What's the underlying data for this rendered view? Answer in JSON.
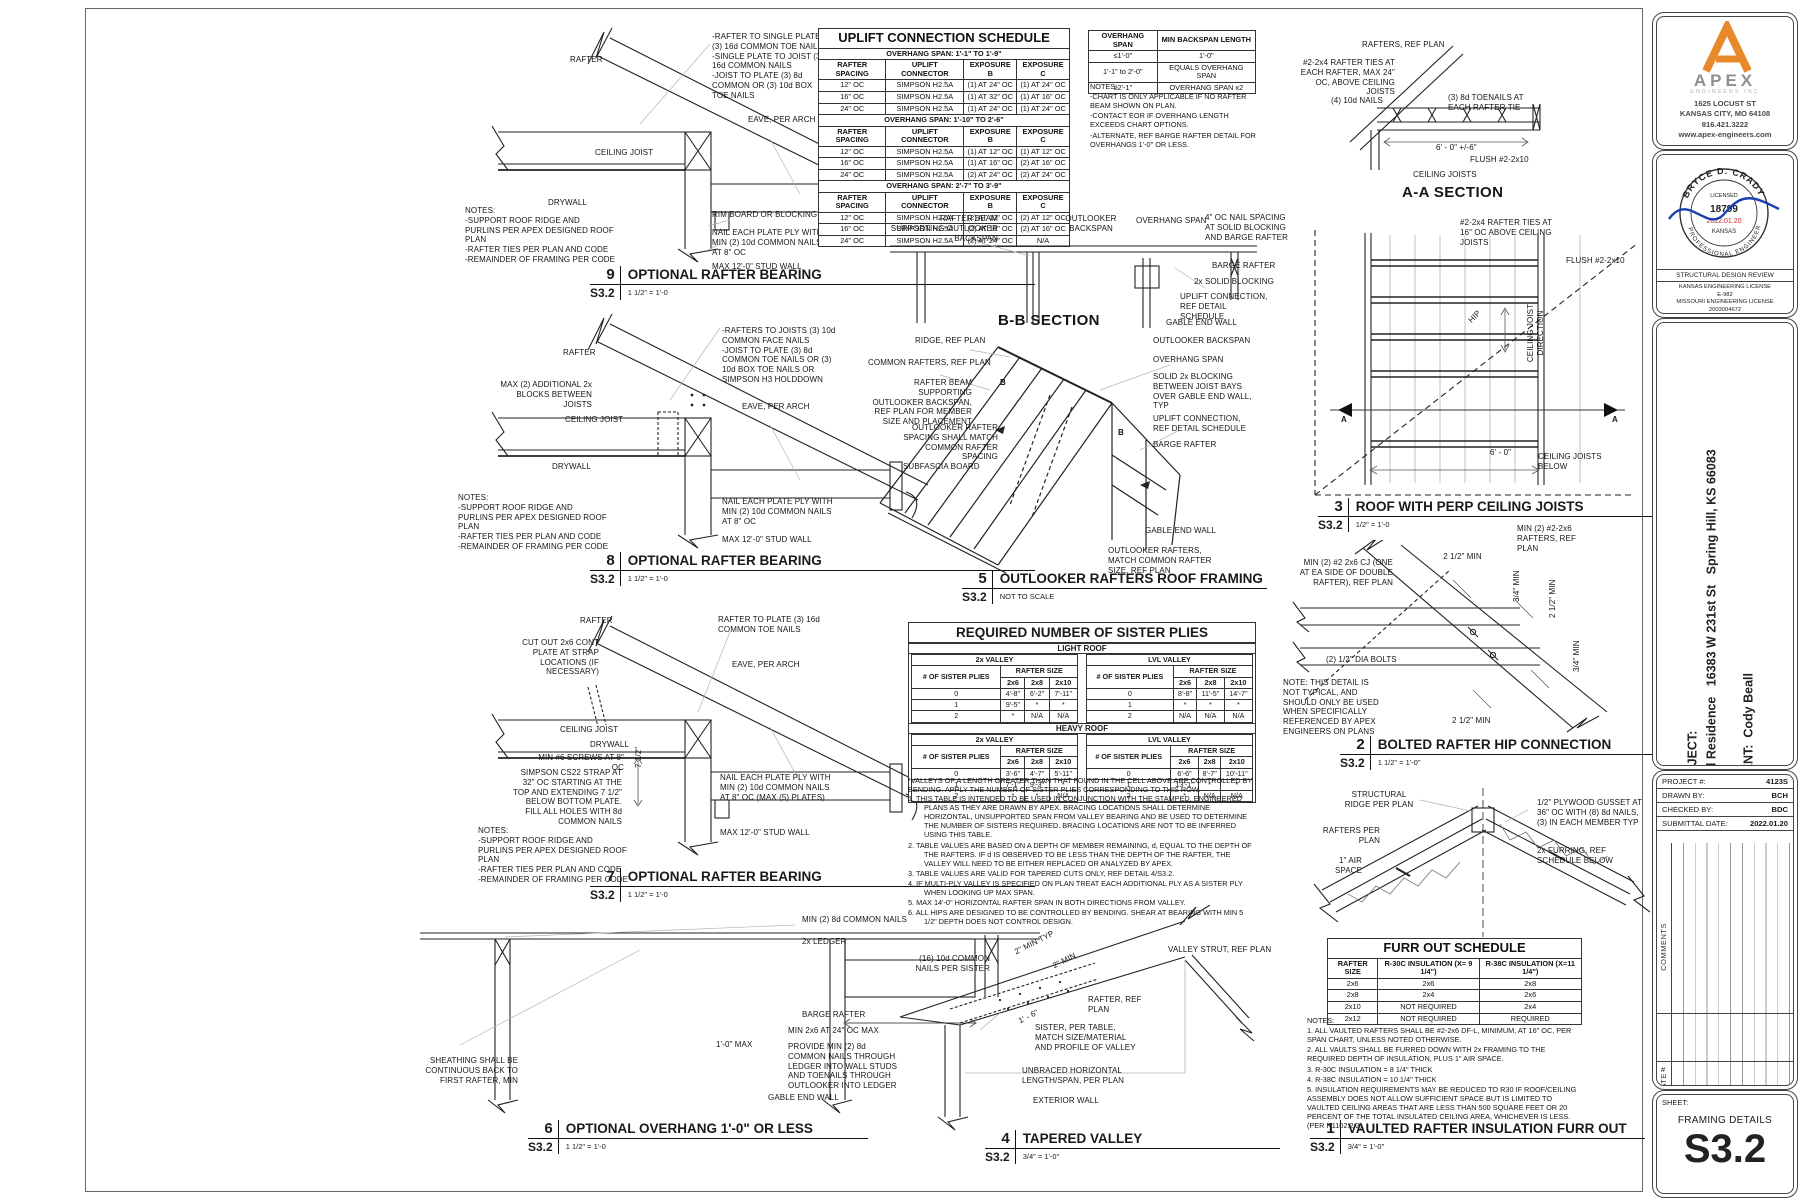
{
  "sheet": {
    "label": "SHEET:",
    "title": "FRAMING DETAILS",
    "number": "S3.2"
  },
  "firm": {
    "name": "APEX",
    "tag": "ENGINEERS INC",
    "address1": "1625 LOCUST ST",
    "address2": "KANSAS CITY, MO 64108",
    "phone": "816.421.3222",
    "web": "www.apex-engineers.com",
    "accent": "#E8892B"
  },
  "stamp": {
    "name": "BRYCE D. CRADY",
    "licensed": "LICENSED",
    "number": "18799",
    "date": "2022.01.20",
    "state": "KANSAS",
    "profession": "PROFESSIONAL ENGINEER",
    "review": "STRUCTURAL DESIGN REVIEW",
    "license1": "KANSAS ENGINEERING LICENSE",
    "license1b": "E-982",
    "license2": "MISSOURI ENGINEERING LICENSE",
    "license2b": "2003004672"
  },
  "project": {
    "label": "PROJECT:",
    "name": "Beall Residence",
    "addr1": "16383 W 231st St",
    "addr2": "Spring Hill, KS 66083",
    "client_label": "CLIENT:",
    "client": "Cody Beall"
  },
  "titleblock": {
    "project_no_label": "PROJECT #:",
    "project_no": "4123S",
    "drawn_label": "DRAWN BY:",
    "drawn": "BCH",
    "checked_label": "CHECKED BY:",
    "checked": "BDC",
    "submittal_label": "SUBMITTAL DATE:",
    "submittal": "2022.01.20",
    "comments": "COMMENTS",
    "date": "DATE",
    "num": "#"
  },
  "uplift": {
    "title": "UPLIFT CONNECTION SCHEDULE",
    "col_headers": [
      "RAFTER SPACING",
      "UPLIFT CONNECTOR",
      "EXPOSURE B",
      "EXPOSURE C"
    ],
    "sections": [
      {
        "span": "OVERHANG SPAN: 1'-1\" TO 1'-9\"",
        "rows": [
          [
            "12\" OC",
            "SIMPSON H2.5A",
            "(1) AT 24\" OC",
            "(1) AT 24\" OC"
          ],
          [
            "16\" OC",
            "SIMPSON H2.5A",
            "(1) AT 32\" OC",
            "(1) AT 16\" OC"
          ],
          [
            "24\" OC",
            "SIMPSON H2.5A",
            "(1) AT 24\" OC",
            "(1) AT 24\" OC"
          ]
        ]
      },
      {
        "span": "OVERHANG SPAN: 1'-10\" TO 2'-6\"",
        "rows": [
          [
            "12\" OC",
            "SIMPSON H2.5A",
            "(1) AT 12\" OC",
            "(1) AT 12\" OC"
          ],
          [
            "16\" OC",
            "SIMPSON H2.5A",
            "(1) AT 16\" OC",
            "(2) AT 16\" OC"
          ],
          [
            "24\" OC",
            "SIMPSON H2.5A",
            "(2) AT 24\" OC",
            "(2) AT 24\" OC"
          ]
        ]
      },
      {
        "span": "OVERHANG SPAN: 2'-7\" TO 3'-9\"",
        "rows": [
          [
            "12\" OC",
            "SIMPSON H2.5A",
            "(2) AT 12\" OC",
            "(2) AT 12\" OC"
          ],
          [
            "16\" OC",
            "SIMPSON H2.5A",
            "(2) AT 16\" OC",
            "(2) AT 16\" OC"
          ],
          [
            "24\" OC",
            "SIMPSON H2.5A",
            "(2) AT 24\" OC",
            "N/A"
          ]
        ]
      }
    ]
  },
  "backspan": {
    "headers": [
      "OVERHANG SPAN",
      "MIN BACKSPAN LENGTH"
    ],
    "rows": [
      [
        "≤1'-0\"",
        "1'-0\""
      ],
      [
        "1'-1\" to 2'-0\"",
        "EQUALS OVERHANG SPAN"
      ],
      [
        "≥2'-1\"",
        "OVERHANG SPAN x2"
      ]
    ],
    "notes": [
      "NOTES:",
      "-CHART IS ONLY APPLICABLE IF NO RAFTER BEAM SHOWN ON PLAN.",
      "-CONTACT EOR IF OVERHANG LENGTH EXCEEDS CHART OPTIONS.",
      "-ALTERNATE, REF BARGE RAFTER DETAIL FOR OVERHANGS 1'-0\" OR LESS."
    ]
  },
  "sister": {
    "title": "REQUIRED NUMBER OF SISTER PLIES",
    "light_label": "LIGHT ROOF",
    "heavy_label": "HEAVY ROOF",
    "plies_header": "# OF SISTER PLIES",
    "size_header": "RAFTER SIZE",
    "sizes": [
      "2x6",
      "2x8",
      "2x10"
    ],
    "light_2x": {
      "label": "2x VALLEY",
      "rows": [
        [
          "0",
          "4'-8\"",
          "6'-2\"",
          "7'-11\""
        ],
        [
          "1",
          "9'-5\"",
          "*",
          "*"
        ],
        [
          "2",
          "*",
          "N/A",
          "N/A"
        ]
      ]
    },
    "light_lvl": {
      "label": "LVL VALLEY",
      "rows": [
        [
          "0",
          "8'-8\"",
          "11'-5\"",
          "14'-7\""
        ],
        [
          "1",
          "*",
          "*",
          "*"
        ],
        [
          "2",
          "N/A",
          "N/A",
          "N/A"
        ]
      ]
    },
    "heavy_2x": {
      "label": "2x VALLEY",
      "rows": [
        [
          "0",
          "3'-6\"",
          "4'-7\"",
          "5'-11\""
        ],
        [
          "1",
          "7'-1\"",
          "9'-3\"",
          "*"
        ],
        [
          "2",
          "*",
          "*",
          "N/A"
        ]
      ]
    },
    "heavy_lvl": {
      "label": "LVL VALLEY",
      "rows": [
        [
          "0",
          "6'-6\"",
          "8'-7\"",
          "10'-11\""
        ],
        [
          "1",
          "13'-1\"",
          "*",
          "*"
        ],
        [
          "2",
          "*",
          "N/A",
          "N/A"
        ]
      ]
    },
    "footnote": "*VALLEYS OF A LENGTH GREATER THAN THAT FOUND IN THE CELL ABOVE ARE CONTROLLED BY BENDING. APPLY THE NUMBER OF SISTER PLIES CORRESPONDING TO THIS ROW.",
    "notes": [
      "1.  THIS TABLE IS INTENDED TO BE USED IN CONJUNCTION WITH THE STAMPED, ENGINEERED PLANS AS THEY ARE DRAWN BY APEX.  BRACING LOCATIONS SHALL DETERMINE HORIZONTAL, UNSUPPORTED SPAN FROM VALLEY BEARING AND BE USED TO DETERMINE THE NUMBER OF SISTERS REQUIRED.  BRACING LOCATIONS ARE NOT TO BE INFERRED USING THIS TABLE.",
      "2.  TABLE VALUES ARE BASED ON A DEPTH OF MEMBER REMAINING, d, EQUAL TO THE DEPTH OF THE RAFTERS. IF d IS OBSERVED TO BE LESS THAN THE DEPTH OF THE RAFTER, THE VALLEY WILL NEED TO BE EITHER REPLACED OR ANALYZED BY APEX.",
      "3.  TABLE VALUES ARE VALID FOR TAPERED CUTS ONLY, REF DETAIL 4/S3.2.",
      "4.  IF MULTI-PLY VALLEY IS SPECIFIED ON PLAN TREAT EACH ADDITIONAL PLY AS A SISTER PLY WHEN LOOKING UP MAX SPAN.",
      "5.  MAX 14'-0\" HORIZONTAL RAFTER SPAN IN BOTH DIRECTIONS FROM VALLEY.",
      "6.  ALL HIPS ARE DESIGNED TO BE CONTROLLED BY BENDING.  SHEAR AT BEARING WITH MIN 5 1/2\" DEPTH DOES NOT CONTROL DESIGN."
    ]
  },
  "furr": {
    "title": "FURR OUT SCHEDULE",
    "headers": [
      "RAFTER SIZE",
      "R-30C INSULATION (X= 9 1/4\")",
      "R-38C INSULATION (X=11 1/4\")"
    ],
    "rows": [
      [
        "2x6",
        "2x6",
        "2x8"
      ],
      [
        "2x8",
        "2x4",
        "2x6"
      ],
      [
        "2x10",
        "NOT REQUIRED",
        "2x4"
      ],
      [
        "2x12",
        "NOT REQUIRED",
        "REQUIRED"
      ]
    ],
    "notes": [
      "NOTES:",
      "1. ALL VAULTED RAFTERS SHALL BE #2-2x6 DF-L, MINIMUM, AT 16\" OC, PER SPAN CHART, UNLESS NOTED OTHERWISE.",
      "2. ALL VAULTS SHALL BE FURRED DOWN WITH 2x FRAMING TO THE REQUIRED DEPTH OF INSULATION, PLUS 1\" AIR SPACE.",
      "3. R-30C INSULATION = 8 1/4\" THICK",
      "4. R-38C INSULATION = 10 1/4\" THICK",
      "5. INSULATION REQUIREMENTS MAY BE REDUCED TO R30 IF ROOF/CEILING ASSEMBLY DOES NOT ALLOW SUFFICIENT SPACE BUT IS LIMITED TO VAULTED CEILING AREAS THAT ARE LESS THAN 500 SQUARE FEET OR 20 PERCENT OF THE TOTAL INSULATED CEILING AREA, WHICHEVER IS LESS. (PER N1102.2.2)"
    ]
  },
  "d9": {
    "num": "9",
    "title": "OPTIONAL RAFTER BEARING",
    "scale": "1 1/2\" = 1'-0",
    "labels": [
      "RAFTER",
      "-RAFTER TO SINGLE PLATE (3) 16d COMMON TOE NAILS\n-SINGLE PLATE TO JOIST (3) 16d COMMON NAILS\n-JOIST TO PLATE (3) 8d COMMON OR (3) 10d BOX TOE NAILS",
      "EAVE, PER ARCH",
      "CEILING JOIST",
      "DRYWALL",
      "RIM BOARD OR BLOCKING",
      "NAIL EACH PLATE PLY WITH MIN (2) 10d COMMON NAILS AT 8\" OC",
      "MAX 12'-0\" STUD WALL",
      "NOTES:\n-SUPPORT ROOF RIDGE AND PURLINS PER APEX DESIGNED ROOF PLAN\n-RAFTER TIES PER PLAN AND CODE\n-REMAINDER OF FRAMING PER CODE"
    ]
  },
  "d8": {
    "num": "8",
    "title": "OPTIONAL RAFTER BEARING",
    "scale": "1 1/2\" = 1'-0",
    "labels": [
      "RAFTER",
      "-RAFTERS TO JOISTS (3) 10d COMMON FACE NAILS\n-JOIST TO PLATE (3) 8d COMMON TOE NAILS OR (3) 10d BOX TOE NAILS OR SIMPSON H3 HOLDDOWN",
      "MAX (2) ADDITIONAL 2x BLOCKS BETWEEN JOISTS",
      "CEILING JOIST",
      "EAVE, PER ARCH",
      "DRYWALL",
      "NAIL EACH PLATE PLY WITH MIN (2) 10d COMMON NAILS AT 8\" OC",
      "MAX 12'-0\" STUD WALL",
      "NOTES:\n-SUPPORT ROOF RIDGE AND PURLINS PER APEX DESIGNED ROOF PLAN\n-RAFTER TIES PER PLAN AND CODE\n-REMAINDER OF FRAMING PER CODE"
    ]
  },
  "d7": {
    "num": "7",
    "title": "OPTIONAL RAFTER BEARING",
    "scale": "1 1/2\" = 1'-0",
    "labels": [
      "RAFTER",
      "CUT OUT 2x6 CONT PLATE AT STRAP LOCATIONS (IF NECESSARY)",
      "RAFTER TO PLATE (3) 16d COMMON TOE NAILS",
      "EAVE, PER ARCH",
      "CEILING JOIST",
      "DRYWALL",
      "MIN #6 SCREWS AT 8\" OC",
      "SIMPSON CS22 STRAP AT 32\" OC STARTING AT THE TOP AND EXTENDING 7 1/2\" BELOW BOTTOM PLATE. FILL ALL HOLES WITH 8d COMMON NAILS",
      "7 1/2\"",
      "NAIL EACH PLATE PLY WITH MIN (2) 10d COMMON NAILS AT 8\" OC (MAX (5) PLATES)",
      "MAX 12'-0\" STUD WALL",
      "NOTES:\n-SUPPORT ROOF RIDGE AND PURLINS PER APEX DESIGNED ROOF PLAN\n-RAFTER TIES PER PLAN AND CODE\n-REMAINDER OF FRAMING PER CODE"
    ]
  },
  "d6": {
    "num": "6",
    "title": "OPTIONAL OVERHANG 1'-0\" OR LESS",
    "scale": "1 1/2\" = 1'-0",
    "labels": [
      "MIN (2) 8d COMMON NAILS",
      "2x LEDGER",
      "BARGE RAFTER",
      "MIN 2x6 AT 24\" OC MAX",
      "1'-0\" MAX",
      "PROVIDE MIN (2) 8d COMMON NAILS THROUGH LEDGER INTO WALL STUDS AND TOENAILS THROUGH OUTLOOKER INTO LEDGER",
      "GABLE END WALL",
      "SHEATHING SHALL BE CONTINUOUS BACK TO FIRST RAFTER, MIN"
    ]
  },
  "d5": {
    "num": "5",
    "title": "OUTLOOKER RAFTERS ROOF FRAMING",
    "scale": "NOT TO SCALE",
    "labels": [
      "RIDGE, REF PLAN",
      "COMMON RAFTERS, REF PLAN",
      "RAFTER BEAM SUPPORTING OUTLOOKER BACKSPAN, REF PLAN FOR MEMBER SIZE AND PLACEMENT",
      "OUTLOOKER RAFTER SPACING SHALL MATCH COMMON RAFTER SPACING",
      "SUBFASCIA BOARD",
      "OUTLOOKER BACKSPAN",
      "OVERHANG SPAN",
      "SOLID 2x BLOCKING BETWEEN JOIST BAYS OVER GABLE END WALL, TYP",
      "UPLIFT CONNECTION, REF DETAIL SCHEDULE",
      "BARGE RAFTER",
      "GABLE END WALL",
      "OUTLOOKER RAFTERS, MATCH COMMON RAFTER SIZE, REF PLAN",
      "B"
    ]
  },
  "d4": {
    "num": "4",
    "title": "TAPERED VALLEY",
    "scale": "3/4\" = 1'-0\"",
    "labels": [
      "(16) 10d COMMON NAILS PER SISTER",
      "2\" MIN TYP",
      "2\" MIN",
      "VALLEY STRUT, REF PLAN",
      "RAFTER, REF PLAN",
      "1' - 6\"",
      "SISTER, PER TABLE, MATCH SIZE/MATERIAL AND PROFILE OF VALLEY",
      "UNBRACED HORIZONTAL LENGTH/SPAN, PER PLAN",
      "EXTERIOR WALL"
    ]
  },
  "d3": {
    "num": "3",
    "title": "ROOF WITH PERP CEILING JOISTS",
    "scale": "1/2\" = 1'-0",
    "labels": [
      "#2-2x4 RAFTER TIES AT 16\" OC ABOVE CEILING JOISTS",
      "FLUSH #2-2x10",
      "HIP",
      "CEILING JOIST DIRECTION",
      "6' - 0\"",
      "CEILING JOISTS BELOW",
      "A"
    ]
  },
  "d2": {
    "num": "2",
    "title": "BOLTED RAFTER HIP CONNECTION",
    "scale": "1 1/2\" = 1'-0\"",
    "labels": [
      "MIN (2) #2-2x6 RAFTERS, REF PLAN",
      "MIN (2) #2 2x6 CJ (ONE AT EA SIDE OF DOUBLE RAFTER), REF PLAN",
      "2 1/2\" MIN",
      "3/4\" MIN",
      "(2) 1/2\" DIA BOLTS",
      "NOTE: THIS DETAIL IS NOT TYPICAL, AND SHOULD ONLY BE USED WHEN SPECIFICALLY REFERENCED BY APEX ENGINEERS ON PLANS"
    ]
  },
  "d1": {
    "num": "1",
    "title": "VAULTED RAFTER INSULATION FURR OUT",
    "scale": "3/4\" = 1'-0\"",
    "labels": [
      "STRUCTURAL RIDGE PER PLAN",
      "RAFTERS PER PLAN",
      "1\" AIR SPACE",
      "1/2\" PLYWOOD GUSSET AT 36\" OC WITH (8) 8d NAILS, (3) IN EACH MEMBER TYP",
      "2x FURRING, REF SCHEDULE BELOW"
    ]
  },
  "aa": {
    "title": "A-A SECTION",
    "labels": [
      "RAFTERS, REF PLAN",
      "#2-2x4 RAFTER TIES AT EACH RAFTER, MAX 24\" OC, ABOVE CEILING JOISTS",
      "(4) 10d NAILS",
      "(3) 8d TOENAILS AT EACH RAFTER TIE",
      "6' - 0\" +/-6\"",
      "FLUSH #2-2x10",
      "CEILING JOISTS"
    ]
  },
  "bb": {
    "title": "B-B SECTION",
    "labels": [
      "RAFTER BEAM SUPPORTING OUTLOOKER BACKSPAN",
      "OUTLOOKER BACKSPAN",
      "OVERHANG SPAN",
      "4\" OC NAIL SPACING AT SOLID BLOCKING AND BARGE RAFTER",
      "BARGE RAFTER",
      "2x SOLID BLOCKING",
      "UPLIFT CONNECTION, REF DETAIL SCHEDULE",
      "GABLE END WALL"
    ]
  }
}
